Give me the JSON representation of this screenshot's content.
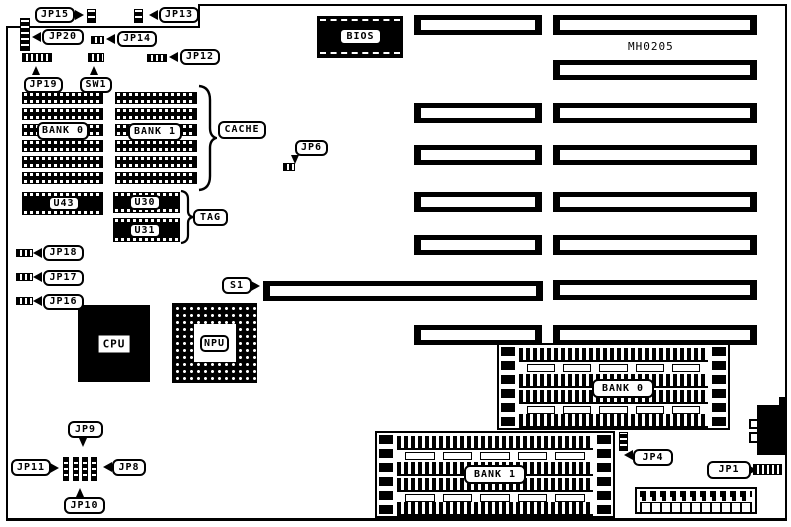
{
  "board": {
    "part_number": "MH0205"
  },
  "labels": {
    "jp1": "JP1",
    "jp4": "JP4",
    "jp6": "JP6",
    "jp8": "JP8",
    "jp9": "JP9",
    "jp10": "JP10",
    "jp11": "JP11",
    "jp12": "JP12",
    "jp13": "JP13",
    "jp14": "JP14",
    "jp15": "JP15",
    "jp16": "JP16",
    "jp17": "JP17",
    "jp18": "JP18",
    "jp19": "JP19",
    "jp20": "JP20",
    "sw1": "SW1",
    "s1": "S1",
    "bios": "BIOS",
    "cpu": "CPU",
    "npu": "NPU",
    "cache": "CACHE",
    "tag": "TAG",
    "cache_bank0": "BANK 0",
    "cache_bank1": "BANK 1",
    "u43": "U43",
    "u30": "U30",
    "u31": "U31",
    "simm_bank0": "BANK 0",
    "simm_bank1": "BANK 1"
  },
  "colors": {
    "ink": "#000000",
    "background": "#ffffff"
  }
}
